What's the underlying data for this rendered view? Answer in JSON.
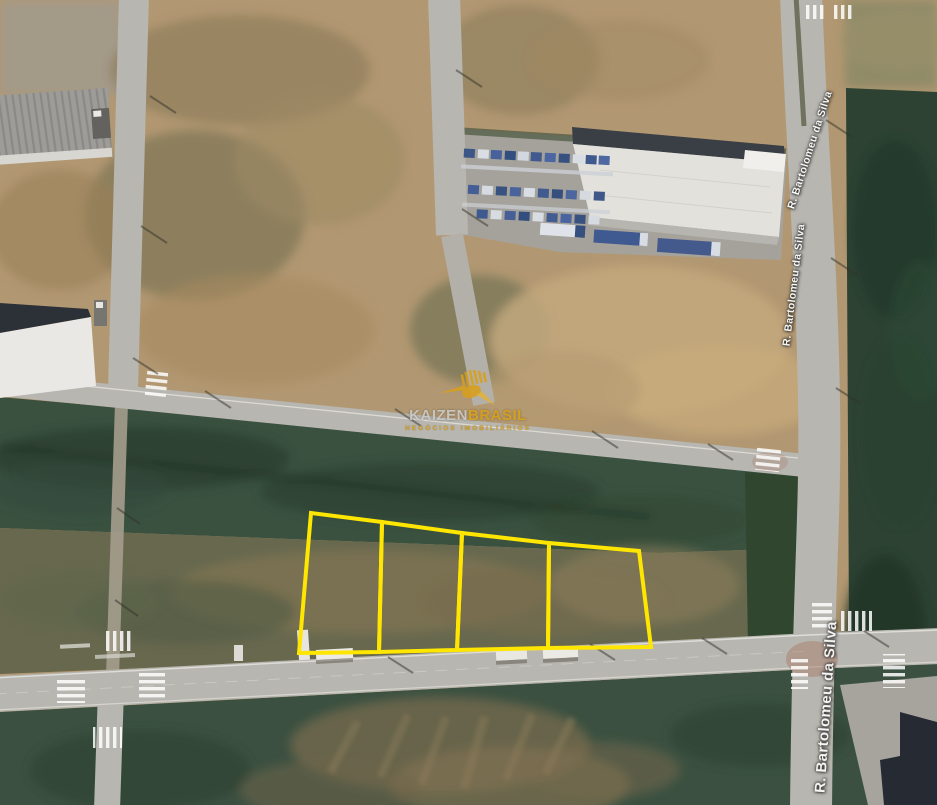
{
  "map": {
    "view": "satellite",
    "streets": [
      {
        "name": "R. Bartolomeu da Silva"
      },
      {
        "name": "R. Bartolomeu da Silva"
      },
      {
        "name": "R. Bartolomeu da Silva"
      }
    ],
    "watermark": {
      "brand_primary": "KAIZEN",
      "brand_secondary": "BRASIL",
      "tagline": "NEGÓCIOS IMOBILIÁRIOS",
      "icon": "hummingbird-icon",
      "gold_color": "#d7a01c",
      "gray_color": "#cbc9c4"
    },
    "parcel_overlay": {
      "color": "#ffe600",
      "stroke_width": 4,
      "count": 4,
      "parcels": [
        {
          "id": 1,
          "points": [
            [
              311,
              513
            ],
            [
              382,
              522
            ],
            [
              379,
              652
            ],
            [
              299,
              653
            ]
          ]
        },
        {
          "id": 2,
          "points": [
            [
              382,
              522
            ],
            [
              462,
              533
            ],
            [
              457,
              650
            ],
            [
              379,
              652
            ]
          ]
        },
        {
          "id": 3,
          "points": [
            [
              462,
              533
            ],
            [
              549,
              543
            ],
            [
              548,
              648
            ],
            [
              457,
              650
            ]
          ]
        },
        {
          "id": 4,
          "points": [
            [
              549,
              543
            ],
            [
              639,
              551
            ],
            [
              651,
              647
            ],
            [
              548,
              648
            ]
          ]
        }
      ]
    }
  }
}
